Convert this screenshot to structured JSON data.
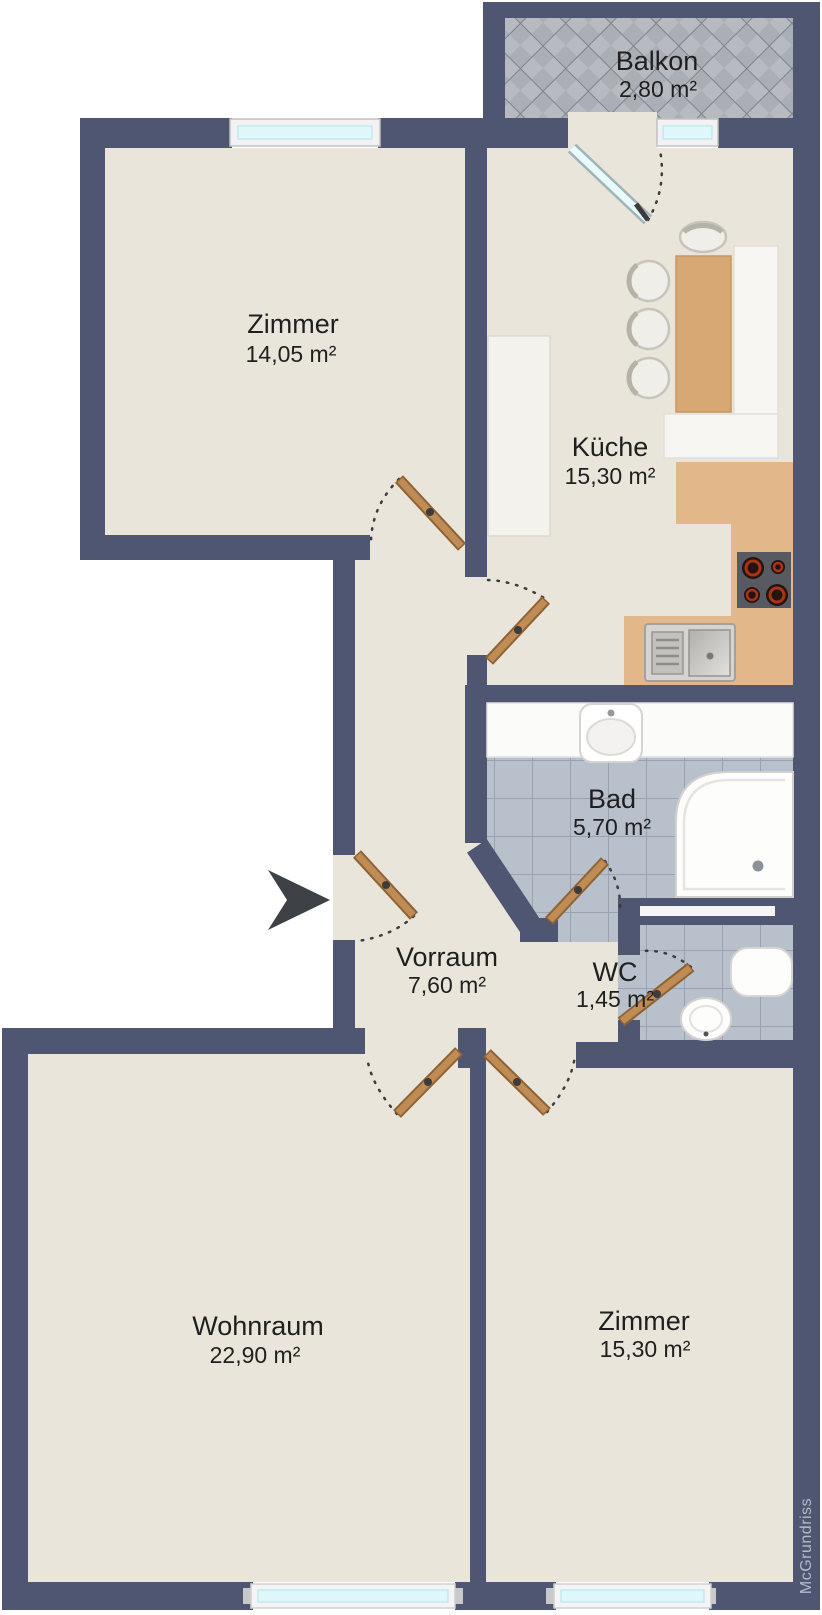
{
  "plan": {
    "title": "Wohnung Grundriss",
    "watermark": "McGrundriss",
    "colors": {
      "wall": "#4e5671",
      "floor": "#e9e5da",
      "bath_tile": "#b8c0cb",
      "balcony_tile": "#b7bac0",
      "counter": "#e2b88b",
      "wood_door": "#c08c55",
      "window_glass": "#dff7fb",
      "arrow": "#3e4145"
    },
    "rooms": [
      {
        "id": "balkon",
        "name": "Balkon",
        "area": "2,80 m²"
      },
      {
        "id": "zimmer-top",
        "name": "Zimmer",
        "area": "14,05 m²"
      },
      {
        "id": "kueche",
        "name": "Küche",
        "area": "15,30 m²"
      },
      {
        "id": "bad",
        "name": "Bad",
        "area": "5,70 m²"
      },
      {
        "id": "vorraum",
        "name": "Vorraum",
        "area": "7,60 m²"
      },
      {
        "id": "wc",
        "name": "WC",
        "area": "1,45 m²"
      },
      {
        "id": "wohnraum",
        "name": "Wohnraum",
        "area": "22,90 m²"
      },
      {
        "id": "zimmer-bottom",
        "name": "Zimmer",
        "area": "15,30 m²"
      }
    ]
  }
}
